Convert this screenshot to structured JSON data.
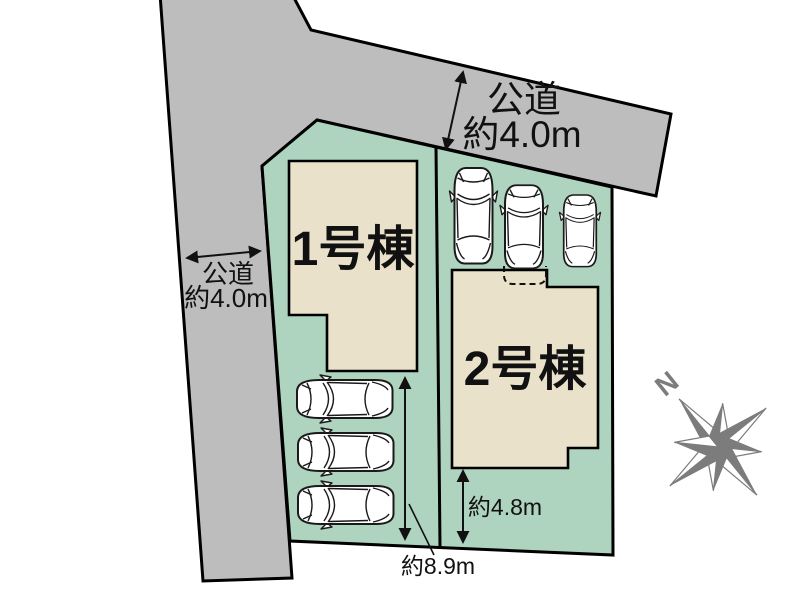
{
  "colors": {
    "road_fill": "#bdbdbd",
    "plot_fill": "#aed3be",
    "building_fill": "#e9e1c9",
    "line": "#000000",
    "text": "#111111",
    "compass": "#7c7c7c",
    "car_fill": "#ffffff"
  },
  "site_plan": {
    "buildings": [
      {
        "label": "1号棟"
      },
      {
        "label": "2号棟"
      }
    ],
    "roads": [
      {
        "position": "top",
        "name": "公道",
        "width_label": "約4.0m"
      },
      {
        "position": "left",
        "name": "公道",
        "width_label": "約4.0m"
      }
    ],
    "dimensions": [
      {
        "target": "plot1-parking-depth",
        "label": "約8.9m"
      },
      {
        "target": "plot2-south-setback",
        "label": "約4.8m"
      }
    ],
    "compass": {
      "north_label": "N"
    },
    "parking": {
      "plot1_spaces": 3,
      "plot2_spaces": 3
    }
  }
}
